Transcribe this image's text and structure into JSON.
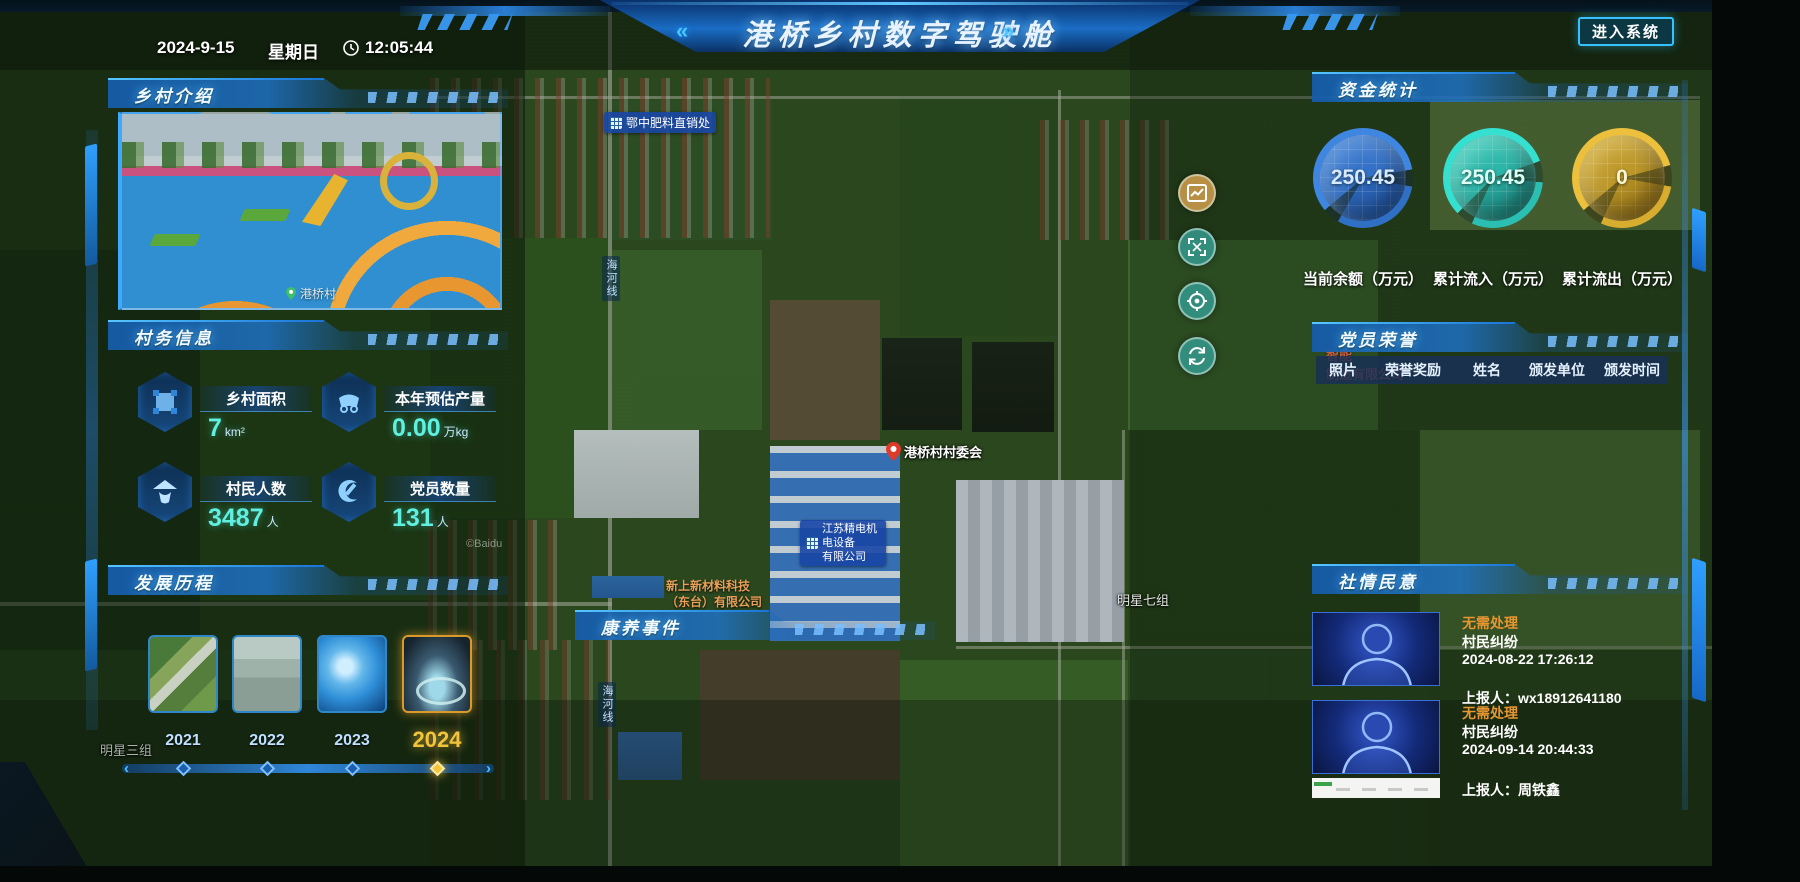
{
  "header": {
    "date": "2024-9-15",
    "weekday": "星期日",
    "time": "12:05:44",
    "title": "港桥乡村数字驾驶舱",
    "title_left_deco": "«",
    "title_right_deco": "»",
    "enter_button": "进入系统"
  },
  "accent_colors": {
    "panel_blue": "#1a74d8",
    "value_cyan": "#5ff0e0",
    "gauge_blue": "#3f86e0",
    "gauge_teal": "#2fd6c8",
    "gauge_gold": "#ecc03c",
    "highlight_gold": "#f2c43c",
    "status_orange": "#e8962f"
  },
  "village_intro": {
    "title": "乡村介绍",
    "photo_caption": "港桥村"
  },
  "village_info": {
    "title": "村务信息",
    "stats": [
      {
        "label": "乡村面积",
        "value": "7",
        "unit": "km²",
        "icon": "area-icon"
      },
      {
        "label": "本年预估产量",
        "value": "0.00",
        "unit": "万kg",
        "icon": "cart-icon"
      },
      {
        "label": "村民人数",
        "value": "3487",
        "unit": "人",
        "icon": "farmer-icon"
      },
      {
        "label": "党员数量",
        "value": "131",
        "unit": "人",
        "icon": "party-icon"
      }
    ]
  },
  "development": {
    "title": "发展历程",
    "years": [
      {
        "label": "2021",
        "selected": false
      },
      {
        "label": "2022",
        "selected": false
      },
      {
        "label": "2023",
        "selected": false
      },
      {
        "label": "2024",
        "selected": true
      }
    ],
    "slider_left_arrow": "‹",
    "slider_right_arrow": "›"
  },
  "funds": {
    "title": "资金统计",
    "gauges": [
      {
        "value": "250.45",
        "label": "当前余额（万元）",
        "color": "#3f86e0"
      },
      {
        "value": "250.45",
        "label": "累计流入（万元）",
        "color": "#2fd6c8"
      },
      {
        "value": "0",
        "label": "累计流出（万元）",
        "color": "#ecc03c"
      }
    ]
  },
  "party_honor": {
    "title": "党员荣誉",
    "columns": [
      "照片",
      "荣誉奖励",
      "姓名",
      "颁发单位",
      "颁发时间"
    ]
  },
  "sentiment": {
    "title": "社情民意",
    "items": [
      {
        "status": "无需处理",
        "category": "村民纠纷",
        "time": "2024-08-22 17:26:12",
        "reporter": "上报人：wx18912641180"
      },
      {
        "status": "无需处理",
        "category": "村民纠纷",
        "time": "2024-09-14 20:44:33",
        "reporter": "上报人：周铁鑫"
      }
    ]
  },
  "health_events": {
    "title": "康养事件"
  },
  "map": {
    "watermark": "©Baidu",
    "labels": {
      "fertilizer_shop": "鄂中肥料直销处",
      "village_committee": "港桥村村委会",
      "js_company_line1": "江苏精电机电设备",
      "js_company_line2": "有限公司",
      "material_company_line1": "新上新材料科技",
      "material_company_line2": "（东台）有限公司",
      "mingxing_7": "明星七组",
      "mingxing_3": "明星三组",
      "manufacture_line1": "智能",
      "manufacture_line2": "制造有限公司",
      "road_top": "海河线",
      "road_bottom": "海河线"
    },
    "controls": [
      {
        "icon": "chart-icon"
      },
      {
        "icon": "fullscreen-icon"
      },
      {
        "icon": "locate-icon"
      },
      {
        "icon": "refresh-icon"
      }
    ]
  }
}
